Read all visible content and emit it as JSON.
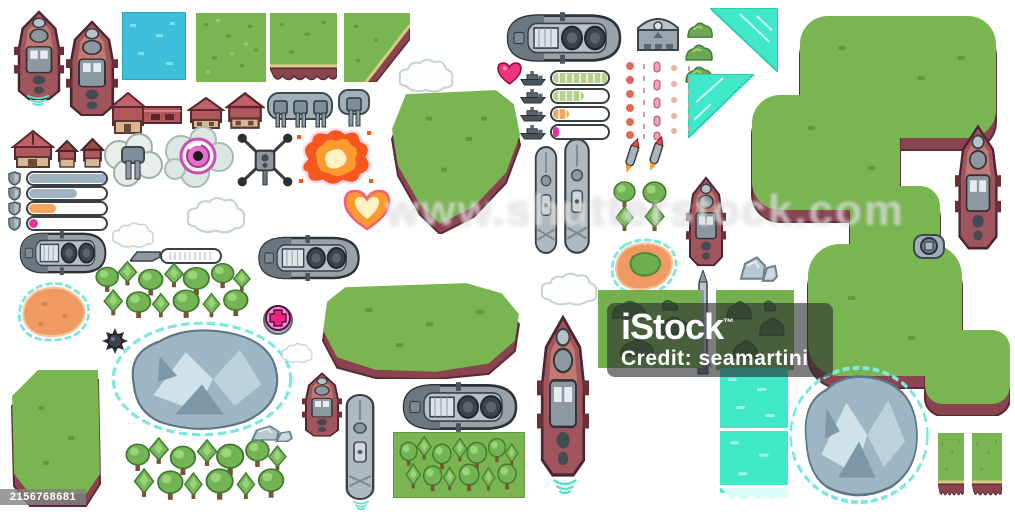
{
  "meta": {
    "description": "Pixel art top-down sea battle game assets sprite sheet: warships, submarines, islands, terrain tiles, trees, buildings, turrets, explosions and HUD bars",
    "canvas": {
      "width": 1015,
      "height": 516
    }
  },
  "watermarks": {
    "center_text": "www.shutterstock.com",
    "istock": {
      "brand": "iStock",
      "tm": "™",
      "credit": "Credit: seamartini"
    },
    "image_id": "2156768681"
  },
  "palette": {
    "grass": "#79b551",
    "cliff": "#8a4450",
    "sand": "#d8cc82",
    "water": "#3fc0da",
    "turquoise": "#3ee8c9",
    "ship_red": "#a0545c",
    "ship_gray": "#9aa5ad",
    "beach_orange": "#ef9a63",
    "glow_magenta": "#e060c8",
    "hud_green": "#b7d08e",
    "hud_steel": "#9fb2c2",
    "hud_orange": "#f5a55e",
    "hud_magenta": "#e0369e",
    "explosion_orange": "#ff9a2e",
    "mountain_gray": "#9db6c4",
    "halo_cyan": "#7ee8e0"
  },
  "hud": {
    "health_rows": [
      {
        "fill": 100,
        "color": "#b7d08e",
        "segmented": true
      },
      {
        "fill": 55,
        "color": "#b7d08e",
        "segmented": true
      },
      {
        "fill": 28,
        "color": "#f5a55e",
        "segmented": true
      },
      {
        "fill": 10,
        "color": "#e0369e",
        "segmented": false
      }
    ],
    "shield_rows": [
      {
        "fill": 100,
        "color": "#9fb2c2",
        "segmented": false
      },
      {
        "fill": 62,
        "color": "#9fb2c2",
        "segmented": false
      },
      {
        "fill": 35,
        "color": "#f5a55e",
        "segmented": false
      },
      {
        "fill": 12,
        "color": "#e0369e",
        "segmented": false
      }
    ]
  },
  "sprites": [
    {
      "name": "island-right-large",
      "sym": "sym-island-right",
      "x": 748,
      "y": 16,
      "w": 262,
      "h": 400
    },
    {
      "name": "island-top-center",
      "sym": "sym-island-top",
      "x": 386,
      "y": 86,
      "w": 140,
      "h": 148
    },
    {
      "name": "island-center",
      "sym": "sym-island-center",
      "x": 315,
      "y": 281,
      "w": 212,
      "h": 98
    },
    {
      "name": "island-bottom-left",
      "sym": "sym-island-bl",
      "x": 8,
      "y": 366,
      "w": 96,
      "h": 142
    },
    {
      "name": "warship-red-vertical-1",
      "sym": "sym-warship-red-v",
      "x": 14,
      "y": 10,
      "w": 50,
      "h": 92
    },
    {
      "name": "ship-wake",
      "sym": "sym-wake",
      "x": 20,
      "y": 94,
      "w": 36,
      "h": 13
    },
    {
      "name": "warship-red-vertical-2",
      "sym": "sym-warship-red-v",
      "x": 66,
      "y": 20,
      "w": 52,
      "h": 98
    },
    {
      "name": "water-tile",
      "sym": "sym-water",
      "x": 122,
      "y": 12,
      "w": 64,
      "h": 68
    },
    {
      "name": "grass-tile",
      "sym": "sym-grass",
      "x": 196,
      "y": 13,
      "w": 70,
      "h": 69
    },
    {
      "name": "grass-cliff-tile",
      "sym": "sym-grass-cliff",
      "x": 270,
      "y": 13,
      "w": 67,
      "h": 69
    },
    {
      "name": "grass-corner-tile",
      "sym": "sym-grass-corner",
      "x": 344,
      "y": 13,
      "w": 66,
      "h": 69
    },
    {
      "name": "battleship-gray-top",
      "sym": "sym-battleship-h",
      "x": 494,
      "y": 10,
      "w": 140,
      "h": 56
    },
    {
      "name": "garage-building",
      "sym": "sym-garage",
      "x": 636,
      "y": 14,
      "w": 44,
      "h": 38
    },
    {
      "name": "bush-1",
      "sym": "sym-bush",
      "x": 686,
      "y": 20,
      "w": 28,
      "h": 19
    },
    {
      "name": "bush-2",
      "sym": "sym-bush",
      "x": 684,
      "y": 42,
      "w": 30,
      "h": 20
    },
    {
      "name": "bush-3",
      "sym": "sym-bush",
      "x": 684,
      "y": 64,
      "w": 30,
      "h": 20
    },
    {
      "name": "waterfall-triangle-1",
      "sym": "sym-tri-a",
      "x": 710,
      "y": 8,
      "w": 68,
      "h": 64
    },
    {
      "name": "waterfall-triangle-2",
      "sym": "sym-tri-b",
      "x": 688,
      "y": 74,
      "w": 66,
      "h": 64
    },
    {
      "name": "warship-red-vertical-right",
      "sym": "sym-warship-red-v",
      "x": 955,
      "y": 124,
      "w": 46,
      "h": 128
    },
    {
      "name": "buoy-turret",
      "sym": "sym-buoy",
      "x": 912,
      "y": 232,
      "w": 34,
      "h": 28
    },
    {
      "name": "health-heart-icon",
      "sym": "sym-heart",
      "x": 497,
      "y": 62,
      "w": 25,
      "h": 23
    },
    {
      "name": "projectile-trails",
      "sym": "sym-ammo",
      "x": 622,
      "y": 60,
      "w": 78,
      "h": 80
    },
    {
      "name": "rocket-pair",
      "sym": "sym-rocket-pair",
      "x": 618,
      "y": 136,
      "w": 52,
      "h": 42
    },
    {
      "name": "house-l-shaped",
      "sym": "sym-house-l",
      "x": 107,
      "y": 91,
      "w": 78,
      "h": 44
    },
    {
      "name": "house-small-1",
      "sym": "sym-house-sm",
      "x": 187,
      "y": 96,
      "w": 38,
      "h": 34
    },
    {
      "name": "house-small-2",
      "sym": "sym-house-sm",
      "x": 225,
      "y": 91,
      "w": 40,
      "h": 39
    },
    {
      "name": "turret-platform-triple",
      "sym": "sym-turret-platform",
      "x": 266,
      "y": 89,
      "w": 68,
      "h": 42
    },
    {
      "name": "turret-single",
      "sym": "sym-turret-single",
      "x": 335,
      "y": 86,
      "w": 38,
      "h": 44
    },
    {
      "name": "barn-house",
      "sym": "sym-barn",
      "x": 11,
      "y": 129,
      "w": 44,
      "h": 40
    },
    {
      "name": "hut-1",
      "sym": "sym-hut",
      "x": 55,
      "y": 139,
      "w": 24,
      "h": 30
    },
    {
      "name": "hut-2",
      "sym": "sym-hut",
      "x": 80,
      "y": 137,
      "w": 25,
      "h": 32
    },
    {
      "name": "turret-in-smoke",
      "sym": "sym-turret-smoke",
      "x": 101,
      "y": 131,
      "w": 64,
      "h": 58
    },
    {
      "name": "magenta-orb-cloud",
      "sym": "sym-orb-cloud",
      "x": 161,
      "y": 125,
      "w": 74,
      "h": 64
    },
    {
      "name": "drone",
      "sym": "sym-drone",
      "x": 235,
      "y": 131,
      "w": 60,
      "h": 58
    },
    {
      "name": "explosion-large",
      "sym": "sym-explosion",
      "x": 293,
      "y": 125,
      "w": 82,
      "h": 64
    },
    {
      "name": "cloud-1",
      "sym": "sym-cloud",
      "x": 184,
      "y": 195,
      "w": 64,
      "h": 40
    },
    {
      "name": "cloud-2",
      "sym": "sym-cloud",
      "x": 110,
      "y": 221,
      "w": 46,
      "h": 28
    },
    {
      "name": "explosion-heart",
      "sym": "sym-explosion-heart",
      "x": 341,
      "y": 189,
      "w": 52,
      "h": 42
    },
    {
      "name": "cloud-3",
      "sym": "sym-cloud",
      "x": 396,
      "y": 57,
      "w": 60,
      "h": 37
    },
    {
      "name": "submarine-vertical-1",
      "sym": "sym-sub-v",
      "x": 532,
      "y": 144,
      "w": 28,
      "h": 112
    },
    {
      "name": "submarine-vertical-2",
      "sym": "sym-sub-v",
      "x": 561,
      "y": 136,
      "w": 32,
      "h": 120
    },
    {
      "name": "tree-quad",
      "sym": "sym-tree-quad",
      "x": 610,
      "y": 180,
      "w": 58,
      "h": 52
    },
    {
      "name": "warship-red-vertical-mid",
      "sym": "sym-warship-red-v",
      "x": 686,
      "y": 176,
      "w": 40,
      "h": 92
    },
    {
      "name": "warship-gray-horizontal",
      "sym": "sym-battleship-h",
      "x": 10,
      "y": 229,
      "w": 106,
      "h": 48
    },
    {
      "name": "gray-wedge",
      "sym": "sym-wedge",
      "x": 130,
      "y": 249,
      "w": 32,
      "h": 13
    },
    {
      "name": "pill-capsule",
      "sym": "sym-pill",
      "x": 160,
      "y": 248,
      "w": 62,
      "h": 16
    },
    {
      "name": "battleship-gray-mid",
      "sym": "sym-battleship-h",
      "x": 247,
      "y": 233,
      "w": 124,
      "h": 50
    },
    {
      "name": "tree-cluster-mid",
      "sym": "sym-cluster",
      "x": 92,
      "y": 260,
      "w": 162,
      "h": 60
    },
    {
      "name": "orange-island-blob",
      "sym": "sym-blob-orange",
      "x": 12,
      "y": 280,
      "w": 86,
      "h": 64
    },
    {
      "name": "sea-mine",
      "sym": "sym-mine",
      "x": 102,
      "y": 328,
      "w": 26,
      "h": 26
    },
    {
      "name": "medic-cross-badge",
      "sym": "sym-medic",
      "x": 263,
      "y": 303,
      "w": 30,
      "h": 32
    },
    {
      "name": "cloud-4",
      "sym": "sym-cloud",
      "x": 538,
      "y": 271,
      "w": 62,
      "h": 36
    },
    {
      "name": "island-orange-beach",
      "sym": "sym-island-orange",
      "x": 607,
      "y": 237,
      "w": 74,
      "h": 60
    },
    {
      "name": "rocks-pair",
      "sym": "sym-rocks",
      "x": 737,
      "y": 251,
      "w": 42,
      "h": 34
    },
    {
      "name": "mountain-lake",
      "sym": "sym-mountain",
      "x": 110,
      "y": 320,
      "w": 184,
      "h": 118
    },
    {
      "name": "cloud-small",
      "sym": "sym-cloud",
      "x": 280,
      "y": 342,
      "w": 34,
      "h": 22
    },
    {
      "name": "boat-red-small",
      "sym": "sym-warship-red-v",
      "x": 302,
      "y": 372,
      "w": 40,
      "h": 66
    },
    {
      "name": "rocket-tall",
      "sym": "sym-rocket-tall",
      "x": 694,
      "y": 270,
      "w": 18,
      "h": 112
    },
    {
      "name": "bush-grass-tile-1",
      "sym": "sym-bush-tile",
      "x": 598,
      "y": 290,
      "w": 104,
      "h": 78
    },
    {
      "name": "bush-grass-tile-2",
      "sym": "sym-bush-tile",
      "x": 716,
      "y": 290,
      "w": 78,
      "h": 80
    },
    {
      "name": "battleship-red-vertical-large",
      "sym": "sym-warship-red-v",
      "x": 537,
      "y": 314,
      "w": 52,
      "h": 166
    },
    {
      "name": "ship-wake-2",
      "sym": "sym-wake",
      "x": 546,
      "y": 478,
      "w": 38,
      "h": 18
    },
    {
      "name": "submarine-vertical-3",
      "sym": "sym-sub-v",
      "x": 342,
      "y": 392,
      "w": 36,
      "h": 110
    },
    {
      "name": "ship-wake-3",
      "sym": "sym-wake",
      "x": 348,
      "y": 500,
      "w": 26,
      "h": 11
    },
    {
      "name": "battleship-gray-bottom",
      "sym": "sym-battleship-h",
      "x": 390,
      "y": 380,
      "w": 140,
      "h": 54
    },
    {
      "name": "trees-on-grass-tile",
      "sym": "sym-trees-grass",
      "x": 393,
      "y": 432,
      "w": 132,
      "h": 66
    },
    {
      "name": "tree-cluster-bottom",
      "sym": "sym-cluster",
      "x": 122,
      "y": 436,
      "w": 168,
      "h": 66
    },
    {
      "name": "rocks-small",
      "sym": "sym-rocks",
      "x": 248,
      "y": 422,
      "w": 46,
      "h": 22
    },
    {
      "name": "cyan-tile",
      "sym": "sym-cyan",
      "x": 720,
      "y": 368,
      "w": 68,
      "h": 60
    },
    {
      "name": "cyan-falls-tile",
      "sym": "sym-cyan-falls",
      "x": 720,
      "y": 431,
      "w": 68,
      "h": 70
    },
    {
      "name": "mountain-bottom-right",
      "sym": "sym-mountain",
      "x": 788,
      "y": 364,
      "w": 142,
      "h": 142
    },
    {
      "name": "cliff-strip-1",
      "sym": "sym-grass-cliff",
      "x": 938,
      "y": 433,
      "w": 26,
      "h": 64
    },
    {
      "name": "cliff-strip-2",
      "sym": "sym-grass-cliff",
      "x": 972,
      "y": 433,
      "w": 30,
      "h": 64
    }
  ]
}
